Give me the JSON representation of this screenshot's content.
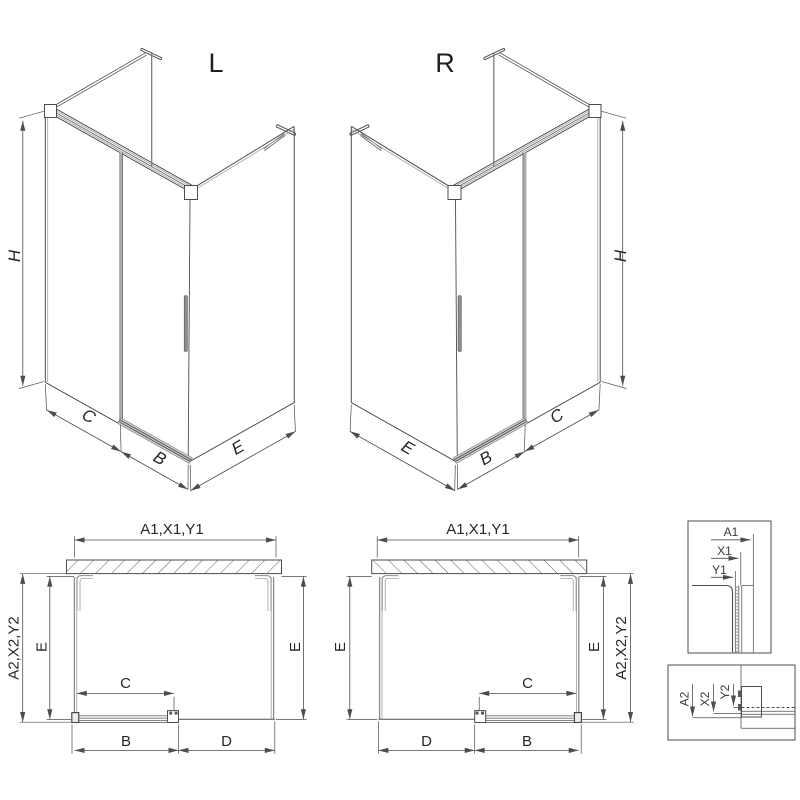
{
  "iso": {
    "left": {
      "label": "L",
      "h": "H",
      "c": "C",
      "b": "B",
      "e": "E"
    },
    "right": {
      "label": "R",
      "h": "H",
      "c": "C",
      "b": "B",
      "e": "E"
    }
  },
  "plan": {
    "left": {
      "width_top": "A1,X1,Y1",
      "depth_total": "A2,X2,Y2",
      "depth_left": "E",
      "depth_right": "E",
      "c": "C",
      "b": "B",
      "d": "D"
    },
    "right": {
      "width_top": "A1,X1,Y1",
      "depth_total": "A2,X2,Y2",
      "depth_left": "E",
      "depth_right": "E",
      "c": "C",
      "b": "B",
      "d": "D"
    }
  },
  "detail": {
    "top": {
      "a": "A1",
      "x": "X1",
      "y": "Y1"
    },
    "bottom": {
      "a": "A2",
      "x": "X2",
      "y": "Y2"
    }
  },
  "colors": {
    "background": "#ffffff",
    "line_dark": "#4d4d4d",
    "line_gray": "#8c8c8c",
    "text": "#262626",
    "track_fill": "#dcdcdc"
  }
}
